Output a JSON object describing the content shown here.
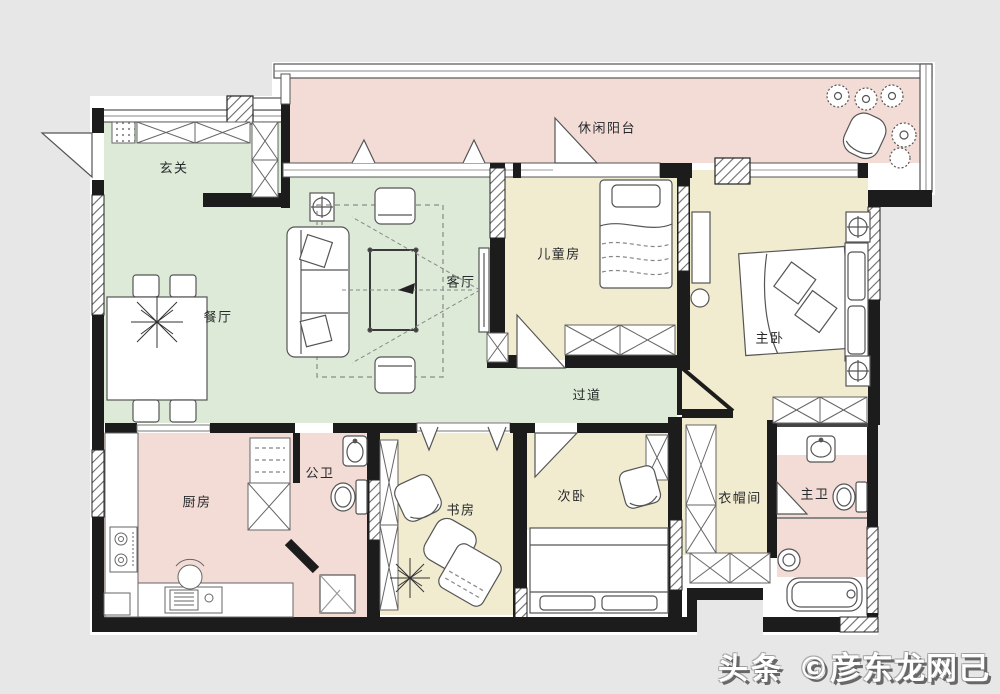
{
  "palette": {
    "background": "#e7e7e7",
    "floor": "#ffffff",
    "wall": "#1c1c1c",
    "furniture_line": "#555555",
    "green": "#dcead7",
    "pink": "#f3dcd6",
    "yellow": "#f1ecd0"
  },
  "rooms": [
    {
      "name": "leisure-balcony",
      "label": "休闲阳台",
      "color": "#f3dcd6"
    },
    {
      "name": "entry",
      "label": "玄关",
      "color": "#dcead7"
    },
    {
      "name": "dining-room",
      "label": "餐厅",
      "color": "#dcead7"
    },
    {
      "name": "living-room",
      "label": "客厅",
      "color": "#dcead7"
    },
    {
      "name": "corridor",
      "label": "过道",
      "color": "#dcead7"
    },
    {
      "name": "kids-room",
      "label": "儿童房",
      "color": "#f1ecd0"
    },
    {
      "name": "master-bedroom",
      "label": "主卧",
      "color": "#f1ecd0"
    },
    {
      "name": "kitchen",
      "label": "厨房",
      "color": "#f3dcd6"
    },
    {
      "name": "guest-bathroom",
      "label": "公卫",
      "color": "#f3dcd6"
    },
    {
      "name": "study",
      "label": "书房",
      "color": "#f1ecd0"
    },
    {
      "name": "second-bedroom",
      "label": "次卧",
      "color": "#f1ecd0"
    },
    {
      "name": "cloakroom",
      "label": "衣帽间",
      "color": "#f1ecd0"
    },
    {
      "name": "master-bathroom",
      "label": "主卫",
      "color": "#f3dcd6"
    }
  ],
  "watermark": {
    "brand": "头条",
    "author": "©彦东龙网己"
  }
}
